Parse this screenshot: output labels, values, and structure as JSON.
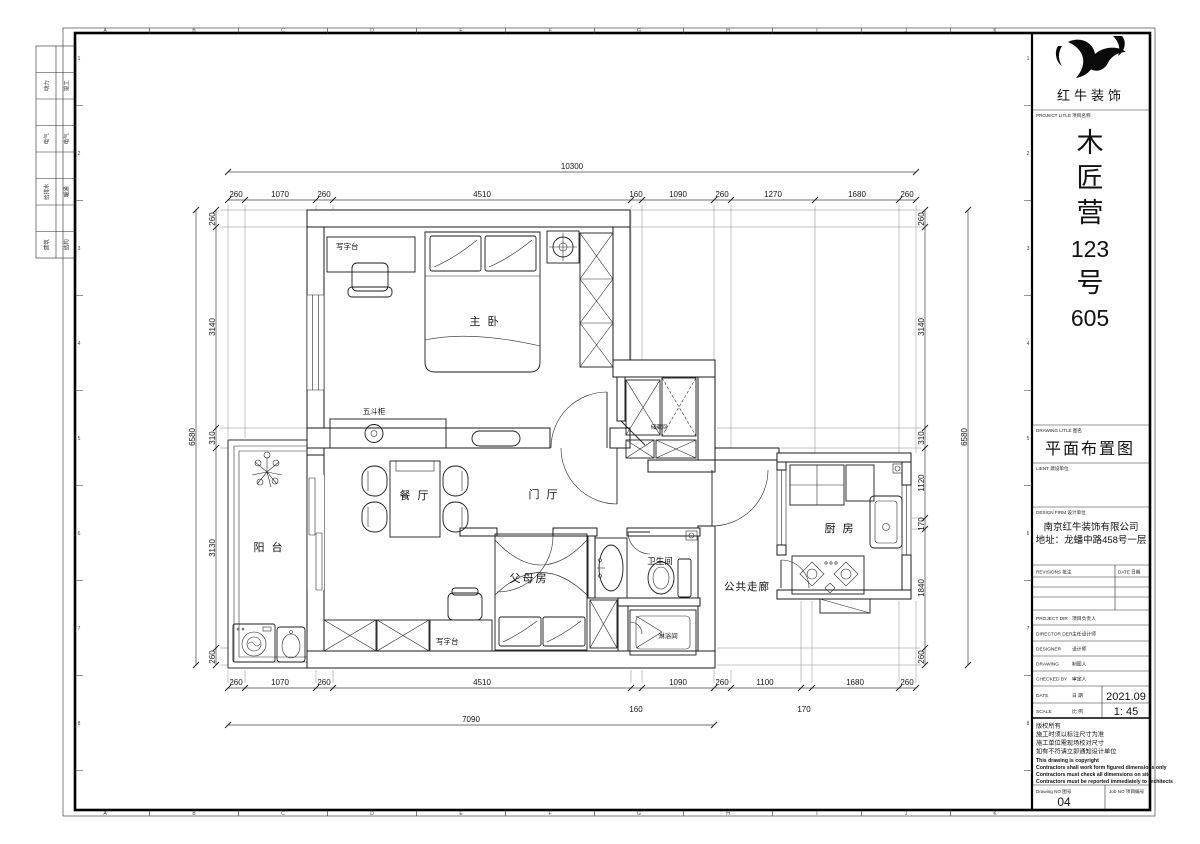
{
  "rooms": {
    "master": "主 卧",
    "dining": "餐 厅",
    "hall": "门 厅",
    "balcony": "阳 台",
    "parents": "父母房",
    "bath": "卫生间",
    "shower": "淋浴间",
    "corridor": "公共走廊",
    "kitchen": "厨 房",
    "storage": "储藏间"
  },
  "furniture": {
    "desk_master": "写字台",
    "chest": "五斗柜",
    "desk_parents": "写字台"
  },
  "dims": {
    "top_total": "10300",
    "top": [
      "260",
      "1070",
      "260",
      "4510",
      "160",
      "1090",
      "260",
      "1270",
      "1680",
      "260"
    ],
    "bottom": [
      "260",
      "1070",
      "260",
      "4510",
      "1090",
      "260",
      "1100",
      "1680",
      "260"
    ],
    "bottom_sub": [
      "160",
      "170"
    ],
    "bottom_total": "7090",
    "left": [
      "260",
      "3140",
      "310",
      "3130",
      "260"
    ],
    "left_total": "6580",
    "right": [
      "260",
      "3140",
      "310",
      "1120",
      "170",
      "1840",
      "260"
    ],
    "right_total": "6580"
  },
  "grid": {
    "letters": [
      "A",
      "B",
      "C",
      "D",
      "E",
      "F",
      "G",
      "H",
      "I",
      "J",
      "K"
    ],
    "numbers": [
      "1",
      "2",
      "3",
      "4",
      "5",
      "6",
      "7",
      "8"
    ]
  },
  "stamps": [
    [
      "动力",
      "竣工"
    ],
    [
      "电气",
      "电气"
    ],
    [
      "给排水",
      "暖通"
    ],
    [
      "建筑",
      "结构"
    ]
  ],
  "titleblock": {
    "company": "红牛装饰",
    "project_label": "PROJECT LITLE  项目名称",
    "project_name": [
      "木",
      "匠",
      "营",
      "123",
      "号",
      "605"
    ],
    "drawing_label": "DRAWING LITLE  图名",
    "drawing_title": "平面布置图",
    "client_label": "LIENT  建设单位",
    "firm_label": "DESIGN FIRM  设计单位",
    "firm_name": "南京红牛装饰有限公司",
    "firm_address": "地址：龙蟠中路458号一层",
    "revisions_label": "REVISIONS  批注",
    "revisions_date_label": "DATE  日期",
    "rows": [
      {
        "label": "PROJECT DIR",
        "cn": "项目负责人",
        "value": ""
      },
      {
        "label": "DIRECTOR DER",
        "cn": "主任设计师",
        "value": ""
      },
      {
        "label": "DESIGNER",
        "cn": "设计师",
        "value": ""
      },
      {
        "label": "DRAWING",
        "cn": "制图人",
        "value": ""
      },
      {
        "label": "CHECKED BY",
        "cn": "审定人",
        "value": ""
      },
      {
        "label": "DATE",
        "cn": "日  期",
        "value": "2021.09"
      },
      {
        "label": "SCALE",
        "cn": "比  例",
        "value": "1: 45"
      }
    ],
    "copyright_cn": [
      "版权所有",
      "施工时须以标注尺寸为准",
      "施工单位需现场校对尺寸",
      "如有不符请立即通知设计单位"
    ],
    "copyright_en": [
      "This drawing is copyright",
      "Contractors shall work form figured dimensions only",
      "Contractors must check all dimensions on site",
      "Contractors must be reported immediately to architects"
    ],
    "drawing_no_label": "Drawing NO  图号",
    "drawing_no": "04",
    "job_no_label": "Job NO  项目编号"
  }
}
